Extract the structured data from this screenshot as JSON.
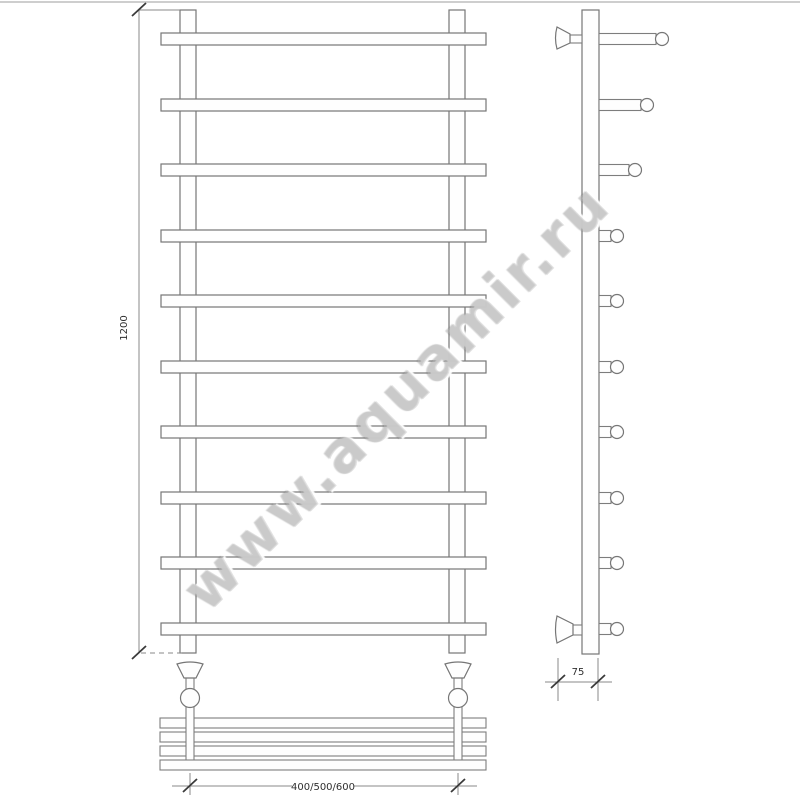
{
  "watermark": {
    "text": "www.aquamir.ru"
  },
  "dimensions": {
    "height": "1200",
    "width_options": "400/500/600",
    "depth": "75"
  },
  "views": {
    "front": {
      "bar_count": 10
    },
    "side": {
      "rung_count": 10
    },
    "shelf": {
      "tube_count": 4
    }
  },
  "colors": {
    "line": "#767676",
    "dimension_line": "#8a8a8a",
    "text": "#2f2f2f",
    "watermark": "#bebebe",
    "photo_edge": "#c6c6c6",
    "background": "#ffffff"
  }
}
